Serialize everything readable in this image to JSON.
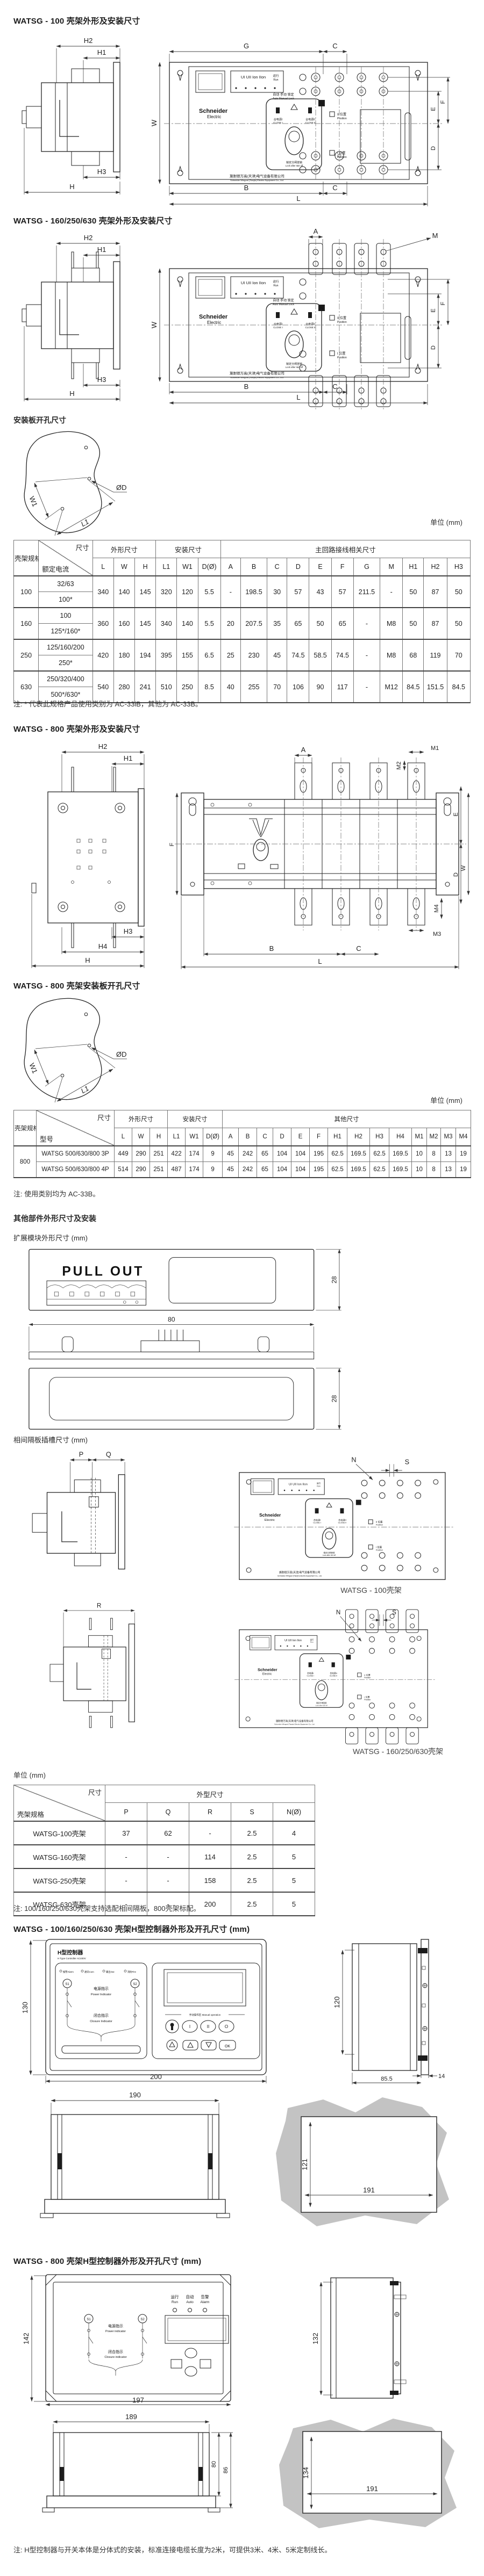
{
  "page": {
    "bg": "#ffffff",
    "line": "#222222",
    "gray_blob": "#c3c3c3"
  },
  "unit_label": "单位 (mm)",
  "titles": {
    "s100": "WATSG - 100 壳架外形及安装尺寸",
    "s160": "WATSG - 160/250/630 壳架外形及安装尺寸",
    "mount": "安装板开孔尺寸",
    "s800": "WATSG - 800 壳架外形及安装尺寸",
    "s800_mount": "WATSG - 800 壳架安装板开孔尺寸",
    "other_parts": "其他部件外形尺寸及安装",
    "expansion": "扩展模块外形尺寸 (mm)",
    "barrier": "相间隔板插槽尺寸 (mm)",
    "ctrl_small": "WATSG - 100/160/250/630 壳架H型控制器外形及开孔尺寸 (mm)",
    "ctrl_800": "WATSG - 800 壳架H型控制器外形及开孔尺寸 (mm)"
  },
  "captions": {
    "frame100": "WATSG - 100壳架",
    "frame160": "WATSG - 160/250/630壳架"
  },
  "notes": {
    "table1": "注: * 代表此规格产品使用类别为 AC-33iB，其他为 AC-33B。",
    "table2": "注: 使用类别均为 AC-33B。",
    "table3": "注: 100/160/250/630壳架支持选配相间隔板，800壳架标配。",
    "final": "注: H型控制器与开关本体是分体式的安装，标准连接电缆长度为2米，可提供3米、4米、5米定制线长。"
  },
  "device": {
    "leds": "UI    UII    Ion    IIon",
    "run_cn": "运行",
    "run_en": "Run",
    "mode_cn": "自动   手动   锁定",
    "mode_en": "Auto  Manual  Lock",
    "brand_top": "Schneider",
    "brand_bot": "Electric",
    "close1_cn": "合电源I",
    "close1_en": "CLOSE I",
    "close2_cn": "合电源II",
    "close2_en": "CLOSE II",
    "lock_cn": "锁定分闸挂锁",
    "lock_en": "Lock after I&II off",
    "padlock": "挂锁Ø3.5mm",
    "pos2_cn": "II 位置",
    "pos2_en": "Position",
    "pos1_cn": "I 位置",
    "pos1_en": "Position",
    "company_cn": "施耐德万高(天津)电气设备有限公司",
    "company_en": "Schneider Wingoal (Tianjin) Electric Equipment Co., Ltd.",
    "n": "N"
  },
  "module": {
    "pull_out": "PULL OUT"
  },
  "ctrl1": {
    "title_cn": "H型控制器",
    "title_en": "H Type Controller AC400V",
    "led1": "报警Alarm",
    "led2": "通讯Com",
    "led3": "输出Out",
    "led4": "消防Fire",
    "s1": "S1",
    "s2": "S2",
    "power_cn": "电源指示",
    "power_en": "Power Indicator",
    "closure_cn": "闭合指示",
    "closure_en": "Closure Indicator",
    "manual_zone": "手动操作区 Manual operation",
    "b1": "I",
    "b2": "II",
    "b3": "O",
    "ok": "OK"
  },
  "ctrl2": {
    "led1_cn": "运行",
    "led2_cn": "自动",
    "led3_cn": "告警",
    "led1_en": "Run",
    "led2_en": "Auto",
    "led3_en": "Alarm",
    "s1": "S1",
    "s2": "S2",
    "power_cn": "电源指示",
    "power_en": "Power indicator",
    "closure_cn": "闭合指示",
    "closure_en": "Closure indicator"
  },
  "dims": {
    "common": {
      "h": "H",
      "h1": "H1",
      "h2": "H2",
      "h3": "H3",
      "h4": "H4",
      "g": "G",
      "c": "C",
      "w": "W",
      "e": "E",
      "f": "F",
      "d": "D",
      "b": "B",
      "l": "L",
      "a": "A",
      "m": "M",
      "m1": "M1",
      "m2": "M2",
      "m3": "M3",
      "m4": "M4",
      "w1": "W1",
      "l1": "L1",
      "dd": "ØD",
      "n": "N",
      "s": "S",
      "p": "P",
      "q": "Q",
      "r": "R"
    },
    "module": {
      "h28": "28",
      "w80": "80"
    },
    "ctrl1": {
      "h130": "130",
      "w200": "200",
      "h120": "120",
      "w14": "14",
      "d855": "85.5",
      "w190": "190",
      "cut_h": "121",
      "cut_w": "191"
    },
    "ctrl2": {
      "h142": "142",
      "w197": "197",
      "h132": "132",
      "w189": "189",
      "h80": "80",
      "h86": "86",
      "cut_h": "134",
      "cut_w": "191"
    }
  },
  "table1": {
    "corner_left": "壳架规格",
    "corner_top": "尺寸",
    "corner_bottom": "额定电流",
    "group_outline": "外形尺寸",
    "group_install": "安装尺寸",
    "group_main": "主回路接线相关尺寸",
    "cols_outline": [
      "L",
      "W",
      "H"
    ],
    "cols_install": [
      "L1",
      "W1",
      "D(Ø)"
    ],
    "cols_main": [
      "A",
      "B",
      "C",
      "D",
      "E",
      "F",
      "G",
      "M",
      "H1",
      "H2",
      "H3"
    ],
    "groups": [
      {
        "frame": "100",
        "currents": [
          "32/63",
          "100*"
        ],
        "values": [
          "340",
          "140",
          "145",
          "320",
          "120",
          "5.5",
          "-",
          "198.5",
          "30",
          "57",
          "43",
          "57",
          "211.5",
          "-",
          "50",
          "87",
          "50"
        ]
      },
      {
        "frame": "160",
        "currents": [
          "100",
          "125*/160*"
        ],
        "values": [
          "360",
          "160",
          "145",
          "340",
          "140",
          "5.5",
          "20",
          "207.5",
          "35",
          "65",
          "50",
          "65",
          "-",
          "M8",
          "50",
          "87",
          "50"
        ]
      },
      {
        "frame": "250",
        "currents": [
          "125/160/200",
          "250*"
        ],
        "values": [
          "420",
          "180",
          "194",
          "395",
          "155",
          "6.5",
          "25",
          "230",
          "45",
          "74.5",
          "58.5",
          "74.5",
          "-",
          "M8",
          "68",
          "119",
          "70"
        ]
      },
      {
        "frame": "630",
        "currents": [
          "250/320/400",
          "500*/630*"
        ],
        "values": [
          "540",
          "280",
          "241",
          "510",
          "250",
          "8.5",
          "40",
          "255",
          "70",
          "106",
          "90",
          "117",
          "-",
          "M12",
          "84.5",
          "151.5",
          "84.5"
        ]
      }
    ]
  },
  "table2": {
    "corner_left": "壳架规格",
    "corner_top": "尺寸",
    "corner_bottom": "型号",
    "group_outline": "外形尺寸",
    "group_install": "安装尺寸",
    "group_other": "其他尺寸",
    "cols_outline": [
      "L",
      "W",
      "H"
    ],
    "cols_install": [
      "L1",
      "W1",
      "D(Ø)"
    ],
    "cols_other": [
      "A",
      "B",
      "C",
      "D",
      "E",
      "F",
      "H1",
      "H2",
      "H3",
      "H4",
      "M1",
      "M2",
      "M3",
      "M4"
    ],
    "frame": "800",
    "rows": [
      {
        "model": "WATSG 500/630/800 3P",
        "values": [
          "449",
          "290",
          "251",
          "422",
          "174",
          "9",
          "45",
          "242",
          "65",
          "104",
          "104",
          "195",
          "62.5",
          "169.5",
          "62.5",
          "169.5",
          "10",
          "8",
          "13",
          "19"
        ]
      },
      {
        "model": "WATSG 500/630/800 4P",
        "values": [
          "514",
          "290",
          "251",
          "487",
          "174",
          "9",
          "45",
          "242",
          "65",
          "104",
          "104",
          "195",
          "62.5",
          "169.5",
          "62.5",
          "169.5",
          "10",
          "8",
          "13",
          "19"
        ]
      }
    ]
  },
  "table3": {
    "corner_top": "尺寸",
    "corner_bottom": "壳架规格",
    "group": "外型尺寸",
    "cols": [
      "P",
      "Q",
      "R",
      "S",
      "N(Ø)"
    ],
    "rows": [
      {
        "frame": "WATSG-100壳架",
        "values": [
          "37",
          "62",
          "-",
          "2.5",
          "4"
        ]
      },
      {
        "frame": "WATSG-160壳架",
        "values": [
          "-",
          "-",
          "114",
          "2.5",
          "5"
        ]
      },
      {
        "frame": "WATSG-250壳架",
        "values": [
          "-",
          "-",
          "158",
          "2.5",
          "5"
        ]
      },
      {
        "frame": "WATSG-630壳架",
        "values": [
          "-",
          "-",
          "200",
          "2.5",
          "5"
        ]
      }
    ]
  }
}
